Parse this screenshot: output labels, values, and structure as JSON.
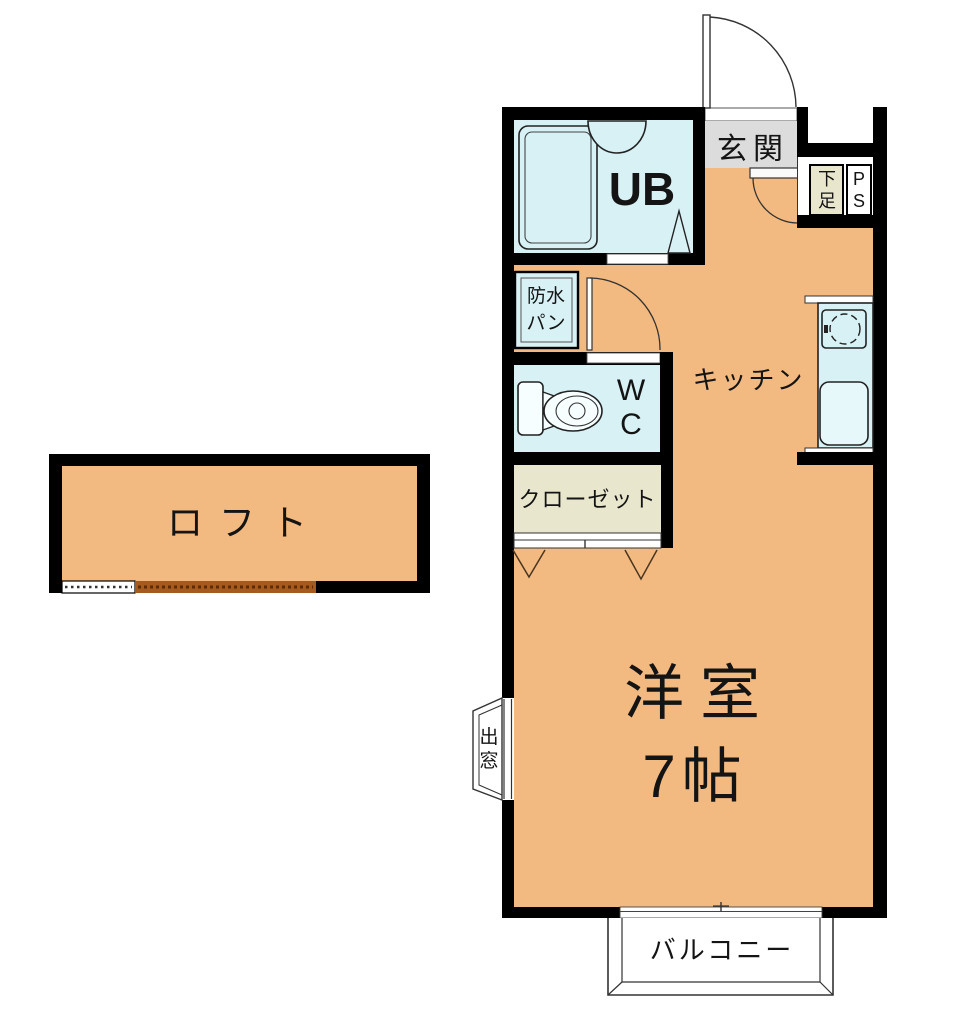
{
  "title": "1R apartment floor plan",
  "rooms": {
    "loft": {
      "label": "ロフト"
    },
    "unit_bath": {
      "label": "UB"
    },
    "entrance": {
      "label": "玄関"
    },
    "shoe_cabinet": {
      "label": "下足"
    },
    "pipe_space": {
      "label": "PS"
    },
    "waterproof_pan": {
      "label": "防水パン"
    },
    "toilet": {
      "label": "WC"
    },
    "kitchen": {
      "label": "キッチン"
    },
    "closet": {
      "label": "クローゼット"
    },
    "western_room": {
      "label": "洋室",
      "size": "7帖"
    },
    "bay_window": {
      "label": "出窓"
    },
    "balcony": {
      "label": "バルコニー"
    }
  },
  "colors": {
    "wall": "#000000",
    "floor_orange": "#F2BA80",
    "wet_area_blue": "#D7F1F5",
    "storage_beige": "#E9E6CE",
    "entrance_gray": "#DCDCDC",
    "loft_edge_brown": "#A55A1E"
  }
}
